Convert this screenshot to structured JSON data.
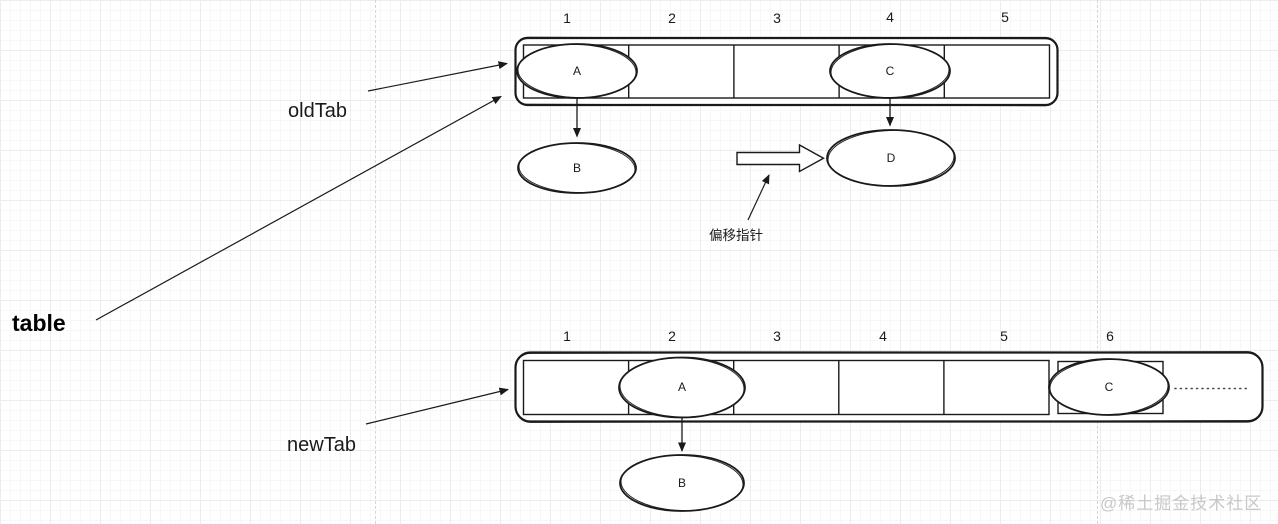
{
  "labels": {
    "old_tab": "oldTab",
    "table": "table",
    "new_tab": "newTab",
    "offset_pointer": "偏移指针"
  },
  "old_table": {
    "indices": [
      "1",
      "2",
      "3",
      "4",
      "5"
    ],
    "slot_a": "A",
    "slot_c": "C",
    "node_b": "B",
    "node_d": "D"
  },
  "new_table": {
    "indices": [
      "1",
      "2",
      "3",
      "4",
      "5",
      "6"
    ],
    "slot_a": "A",
    "slot_c": "C",
    "node_b": "B"
  },
  "watermark": "@稀土掘金技术社区",
  "colors": {
    "stroke": "#1a1a1a",
    "grid_minor": "#f7f7f7",
    "grid_major": "#ececec",
    "page_divider": "#d6d6d6",
    "watermark": "#c8c8c8"
  }
}
